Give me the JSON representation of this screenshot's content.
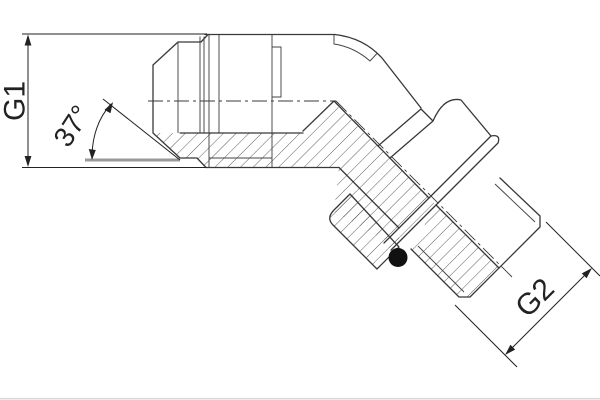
{
  "drawing": {
    "description": "Sectional technical drawing of a 45-degree elbow hydraulic adapter fitting",
    "labels": {
      "g1": "G1",
      "angle": "37°",
      "g2": "G2"
    },
    "colors": {
      "background": "#ffffff",
      "outline": "#383838",
      "dimension": "#222222",
      "reference_line": "#999999",
      "oring": "#111111"
    }
  }
}
